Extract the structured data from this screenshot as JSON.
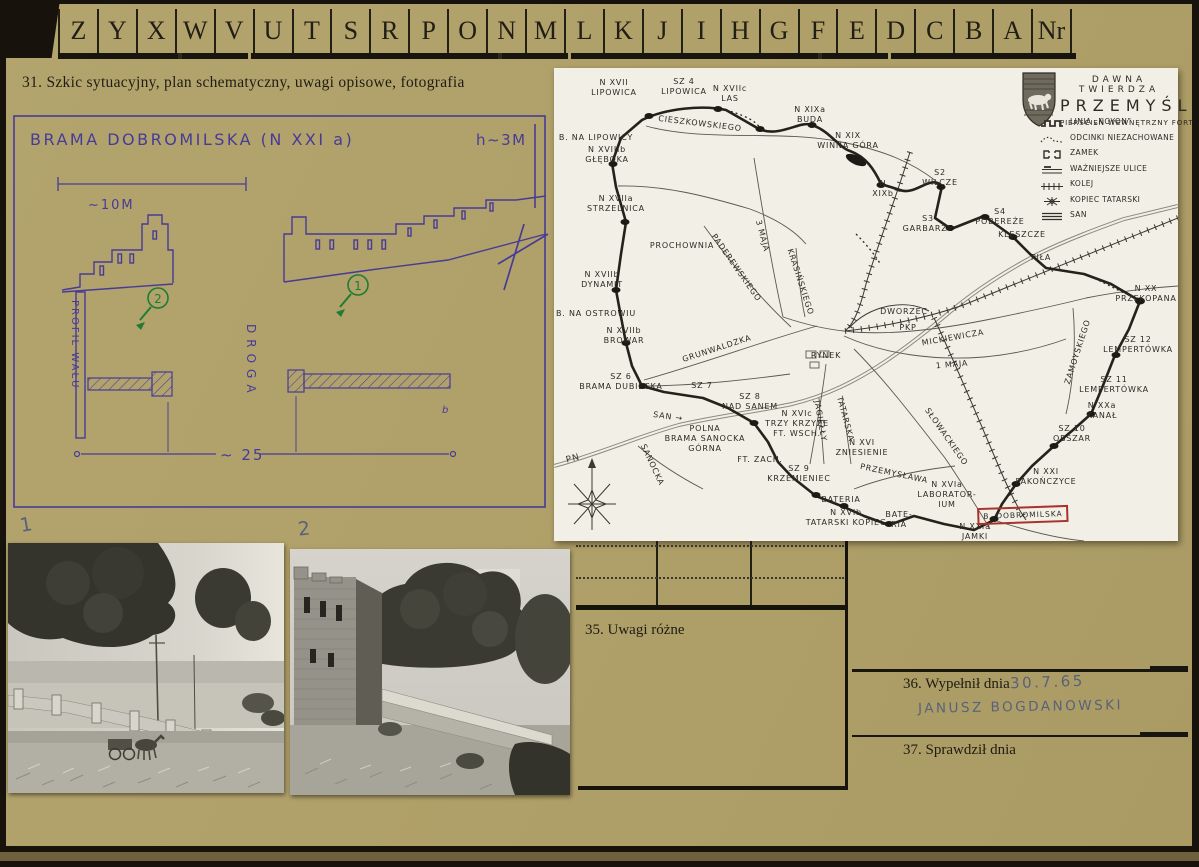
{
  "tabs": [
    "Z",
    "Y",
    "X",
    "W",
    "V",
    "U",
    "T",
    "S",
    "R",
    "P",
    "O",
    "N",
    "M",
    "L",
    "K",
    "J",
    "I",
    "H",
    "G",
    "F",
    "E",
    "D",
    "C",
    "B",
    "A",
    "Nr"
  ],
  "section31": "31. Szkic sytuacyjny, plan schematyczny, uwagi opisowe, fotografia",
  "sketch": {
    "title": "BRAMA DOBROMILSKA (N XXI a)",
    "height_note": "h∼3M",
    "scale_top": "∼10M",
    "scale_bottom": "∼ 25",
    "profil_walu": "PROFIL WAŁU",
    "droga": "DROGA",
    "marker_1": "1",
    "marker_2": "2",
    "squiggle": "b"
  },
  "map": {
    "title_line1": "DAWNA TWIERDZA",
    "title_line2": "PRZEMYŚL",
    "subtitle": "PIERŚCIEŃ WEWNĘTRZNY FORT",
    "compass_label": "PN",
    "highlight_label": "B. DOBROMILSKA",
    "legend": [
      {
        "icon": "noyon-line-icon",
        "label": "LINIA „NOYON”"
      },
      {
        "icon": "dotted-line-icon",
        "label": "ODCINKI NIEZACHOWANE"
      },
      {
        "icon": "castle-icon",
        "label": "ZAMEK"
      },
      {
        "icon": "street-icon",
        "label": "WAŻNIEJSZE ULICE"
      },
      {
        "icon": "railway-icon",
        "label": "KOLEJ"
      },
      {
        "icon": "mound-icon",
        "label": "KOPIEC TATARSKI"
      },
      {
        "icon": "river-icon",
        "label": "SAN"
      }
    ],
    "labels": [
      {
        "t": "N XVII\nLIPOWICA",
        "x": 60,
        "y": 20
      },
      {
        "t": "SZ 4\nLIPOWICA",
        "x": 130,
        "y": 19
      },
      {
        "t": "N XVIIc\nLAS",
        "x": 176,
        "y": 26
      },
      {
        "t": "B. NA LIPOWICY",
        "x": 42,
        "y": 70
      },
      {
        "t": "N XVIIIb\nGŁĘBOKA",
        "x": 53,
        "y": 87
      },
      {
        "t": "CIESZKOWSKIEGO",
        "x": 146,
        "y": 56,
        "r": 7
      },
      {
        "t": "N XVIIa\nSTRZELNICA",
        "x": 62,
        "y": 136
      },
      {
        "t": "PROCHOWNIA",
        "x": 128,
        "y": 178
      },
      {
        "t": "PADEREWSKIEGO",
        "x": 182,
        "y": 200,
        "r": 55
      },
      {
        "t": "N XVIIb\nDYNAMIT",
        "x": 48,
        "y": 212
      },
      {
        "t": "B. NA OSTROWIU",
        "x": 42,
        "y": 246
      },
      {
        "t": "N XVIIb\nBROWAR",
        "x": 70,
        "y": 268
      },
      {
        "t": "3 MAJA",
        "x": 208,
        "y": 168,
        "r": 75
      },
      {
        "t": "N XIXa\nBUDA",
        "x": 256,
        "y": 47
      },
      {
        "t": "N XIX\nWINNA GÓRA",
        "x": 294,
        "y": 73
      },
      {
        "t": "N\nXIXb",
        "x": 329,
        "y": 121
      },
      {
        "t": "S2\nWILCZE",
        "x": 386,
        "y": 110
      },
      {
        "t": "S3\nGARBARZE",
        "x": 374,
        "y": 156
      },
      {
        "t": "S4\nPOBEREŻE",
        "x": 446,
        "y": 149
      },
      {
        "t": "KLESZCZE",
        "x": 468,
        "y": 167
      },
      {
        "t": "PIŁA",
        "x": 487,
        "y": 190
      },
      {
        "t": "N XX\nPRZEKOPANA",
        "x": 592,
        "y": 226
      },
      {
        "t": "SZ 12 LEMPERTÓWKA",
        "x": 584,
        "y": 277
      },
      {
        "t": "ZAMOYSKIEGO",
        "x": 524,
        "y": 284,
        "r": -72
      },
      {
        "t": "SZ 11\nLEMPERTÓWKA",
        "x": 560,
        "y": 317
      },
      {
        "t": "N XXa\nKANAŁ",
        "x": 548,
        "y": 343
      },
      {
        "t": "SZ 10\nOBSZAR",
        "x": 518,
        "y": 366
      },
      {
        "t": "N XXI\nPAKOŃCZYCE",
        "x": 492,
        "y": 409
      },
      {
        "t": "N XXIa\nJAMKI",
        "x": 421,
        "y": 464
      },
      {
        "t": "SŁOWACKIEGO",
        "x": 392,
        "y": 369,
        "r": 55
      },
      {
        "t": "N XVI\nZNIESIENIE",
        "x": 308,
        "y": 380
      },
      {
        "t": "PRZEMYSŁAWA",
        "x": 340,
        "y": 406,
        "r": 12
      },
      {
        "t": "SZ 9\nKRZEMIENIEC",
        "x": 245,
        "y": 406
      },
      {
        "t": "FT. ZACH.",
        "x": 206,
        "y": 392
      },
      {
        "t": "N XVIc\nTRZY KRZYŻE\nFT. WSCH.",
        "x": 243,
        "y": 356
      },
      {
        "t": "JAGIEŁŁY",
        "x": 266,
        "y": 353,
        "r": 80
      },
      {
        "t": "TATARSKA",
        "x": 291,
        "y": 351,
        "r": 75
      },
      {
        "t": "BATERIA",
        "x": 287,
        "y": 432
      },
      {
        "t": "N XVIb\nTATARSKI KOPIEC",
        "x": 292,
        "y": 450
      },
      {
        "t": "BATE-\nRIA",
        "x": 345,
        "y": 452
      },
      {
        "t": "N XVIa\nLABORATOR-\nIUM",
        "x": 393,
        "y": 427
      },
      {
        "t": "POLNA\nBRAMA SANOCKA\nGÓRNA",
        "x": 151,
        "y": 371
      },
      {
        "t": "SANOCKA",
        "x": 98,
        "y": 397,
        "r": 65
      },
      {
        "t": "SZ 8\nNAD SANEM",
        "x": 196,
        "y": 334
      },
      {
        "t": "SZ 7",
        "x": 148,
        "y": 318
      },
      {
        "t": "SZ 6\nBRAMA DUBIECKA",
        "x": 67,
        "y": 314
      },
      {
        "t": "SAN →",
        "x": 114,
        "y": 349,
        "r": 8
      },
      {
        "t": "GRUNWALDZKA",
        "x": 163,
        "y": 281,
        "r": -18
      },
      {
        "t": "RYNEK",
        "x": 272,
        "y": 288
      },
      {
        "t": "DWORZEC",
        "x": 350,
        "y": 244
      },
      {
        "t": "PKP",
        "x": 354,
        "y": 260
      },
      {
        "t": "MICKIEWICZA",
        "x": 399,
        "y": 270,
        "r": -10
      },
      {
        "t": "1 MAJA",
        "x": 398,
        "y": 297,
        "r": -5
      },
      {
        "t": "KRASIŃSKIEGO",
        "x": 246,
        "y": 214,
        "r": 72
      }
    ]
  },
  "photos": {
    "label_1": "1",
    "label_2": "2"
  },
  "section35": "35. Uwagi różne",
  "section36_label": "36. Wypełnił dnia",
  "section36_date": "30.7.65",
  "section36_name": "JANUSZ BOGDANOWSKI",
  "section37": "37. Sprawdził dnia"
}
